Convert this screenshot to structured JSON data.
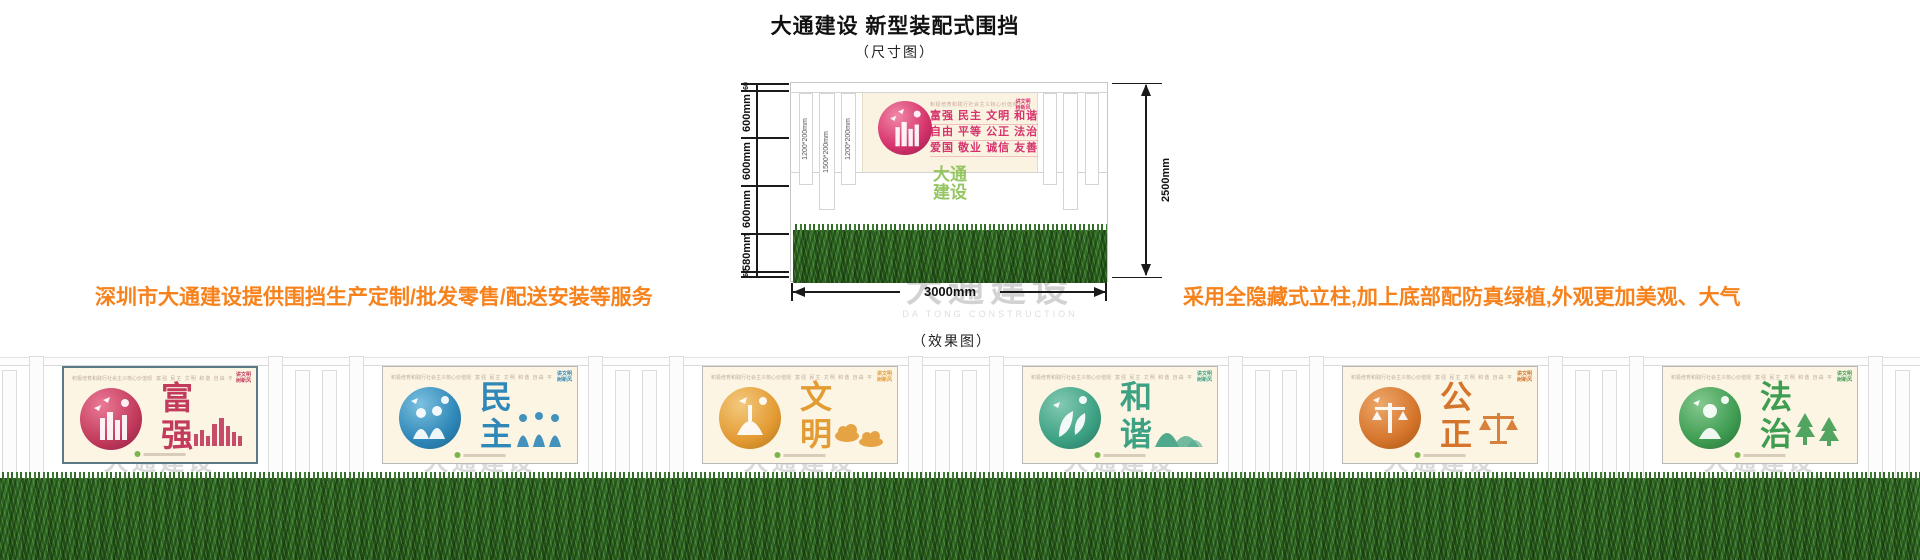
{
  "header": {
    "title": "大通建设 新型装配式围挡",
    "subtitle": "（尺寸图）"
  },
  "notes": {
    "left": "深圳市大通建设提供围挡生产定制/批发零售/配送安装等服务",
    "right": "采用全隐藏式立柱,加上底部配防真绿植,外观更加美观、大气"
  },
  "dimension_diagram": {
    "left_segments": [
      "60",
      "600mm",
      "600mm",
      "600mm",
      "580mm",
      "60"
    ],
    "total_height": "2500mm",
    "total_width": "3000mm",
    "post_labels": [
      "1200*200mm",
      "1500*200mm",
      "1200*200mm"
    ],
    "panel": {
      "heading": "积极培育和践行社会主义核心价值观",
      "slogan_lines": [
        "富强 民主 文明 和谐",
        "自由 平等 公正 法治",
        "爱国 敬业 诚信 友善"
      ],
      "corner_tag_line1": "讲文明",
      "corner_tag_line2": "树新风"
    },
    "green_watermark_line1": "大通",
    "green_watermark_line2": "建设",
    "gray_watermark": "大通建设",
    "gray_watermark_sub": "DA TONG CONSTRUCTION"
  },
  "effect_diagram": {
    "label": "（效果图）",
    "watermark": "大通建设",
    "watermark_sub": "DA TONG CONSTRUCTION",
    "panel_heading": "积极培育和践行社会主义核心价值观",
    "panel_values_row": "富强 民主 文明 和谐 自由 平等 公正 法治 爱国 敬业 诚信 友善",
    "corner_tag_line1": "讲文明",
    "corner_tag_line2": "树新风",
    "panels": [
      {
        "name": "富强",
        "char1": "富",
        "char2": "强",
        "color": "#c23a5c",
        "color_dark": "#8f1f44",
        "color_light": "#ea7a96"
      },
      {
        "name": "民主",
        "char1": "民",
        "char2": "主",
        "color": "#2f88b8",
        "color_dark": "#1c6390",
        "color_light": "#7cc0e0"
      },
      {
        "name": "文明",
        "char1": "文",
        "char2": "明",
        "color": "#e39b33",
        "color_dark": "#b5761a",
        "color_light": "#f3c97e"
      },
      {
        "name": "和谐",
        "char1": "和",
        "char2": "谐",
        "color": "#3da183",
        "color_dark": "#257762",
        "color_light": "#82c9b2"
      },
      {
        "name": "公正",
        "char1": "公",
        "char2": "正",
        "color": "#d5752c",
        "color_dark": "#a65414",
        "color_light": "#eda869"
      },
      {
        "name": "法治",
        "char1": "法",
        "char2": "治",
        "color": "#3f9d52",
        "color_dark": "#277039",
        "color_light": "#85c88f"
      }
    ]
  },
  "colors": {
    "accent_orange": "#f7821c",
    "slogan_pink": "#d6336c",
    "green_logo": "#7ab648",
    "watermark_gray": "#d2d2d2",
    "grass_dark": "#153a0e"
  }
}
